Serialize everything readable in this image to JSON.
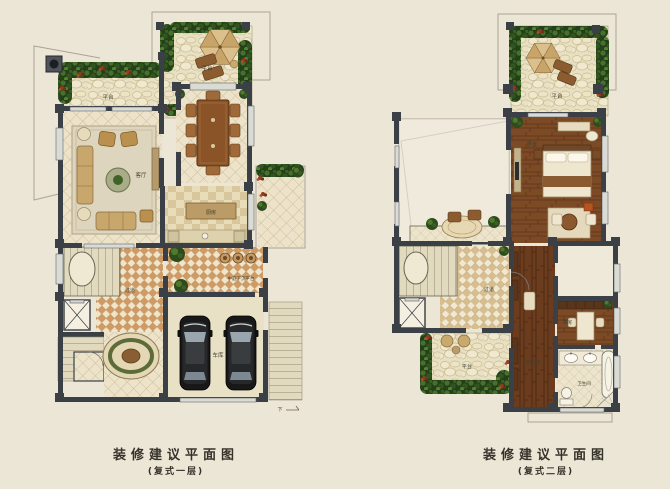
{
  "colors": {
    "c-bg": "#ece6d7",
    "c-wall": "#3a4045",
    "c-label": "#43402f",
    "c-caption": "#35322a",
    "c-wood": "#7c4a25",
    "c-wood-dark": "#6b3c1d",
    "c-tile-orange": "#d09a62",
    "c-stone": "#e8e0c2",
    "c-shrub-green": "#2e4b1e",
    "c-flower-red": "#933a1e"
  },
  "left_plan": {
    "caption": "装修建议平面图",
    "subcaption": "(复式一层)",
    "labels": {
      "terrace_upper": "平台",
      "terrace_main": "平台",
      "living_room": "客厅",
      "kitchen": "厨房",
      "hallway": "过道",
      "sunken_courtyard": "中庭下沉平台",
      "garage": "车库",
      "down_marker": "下"
    }
  },
  "right_plan": {
    "caption": "装修建议平面图",
    "subcaption": "(复式二层)",
    "labels": {
      "terrace_upper": "平台",
      "bedroom": "卧室",
      "hallway": "过道",
      "terrace_lower": "平台",
      "master_bedroom": "主卧室",
      "study": "书房",
      "bathroom": "卫生间"
    }
  }
}
